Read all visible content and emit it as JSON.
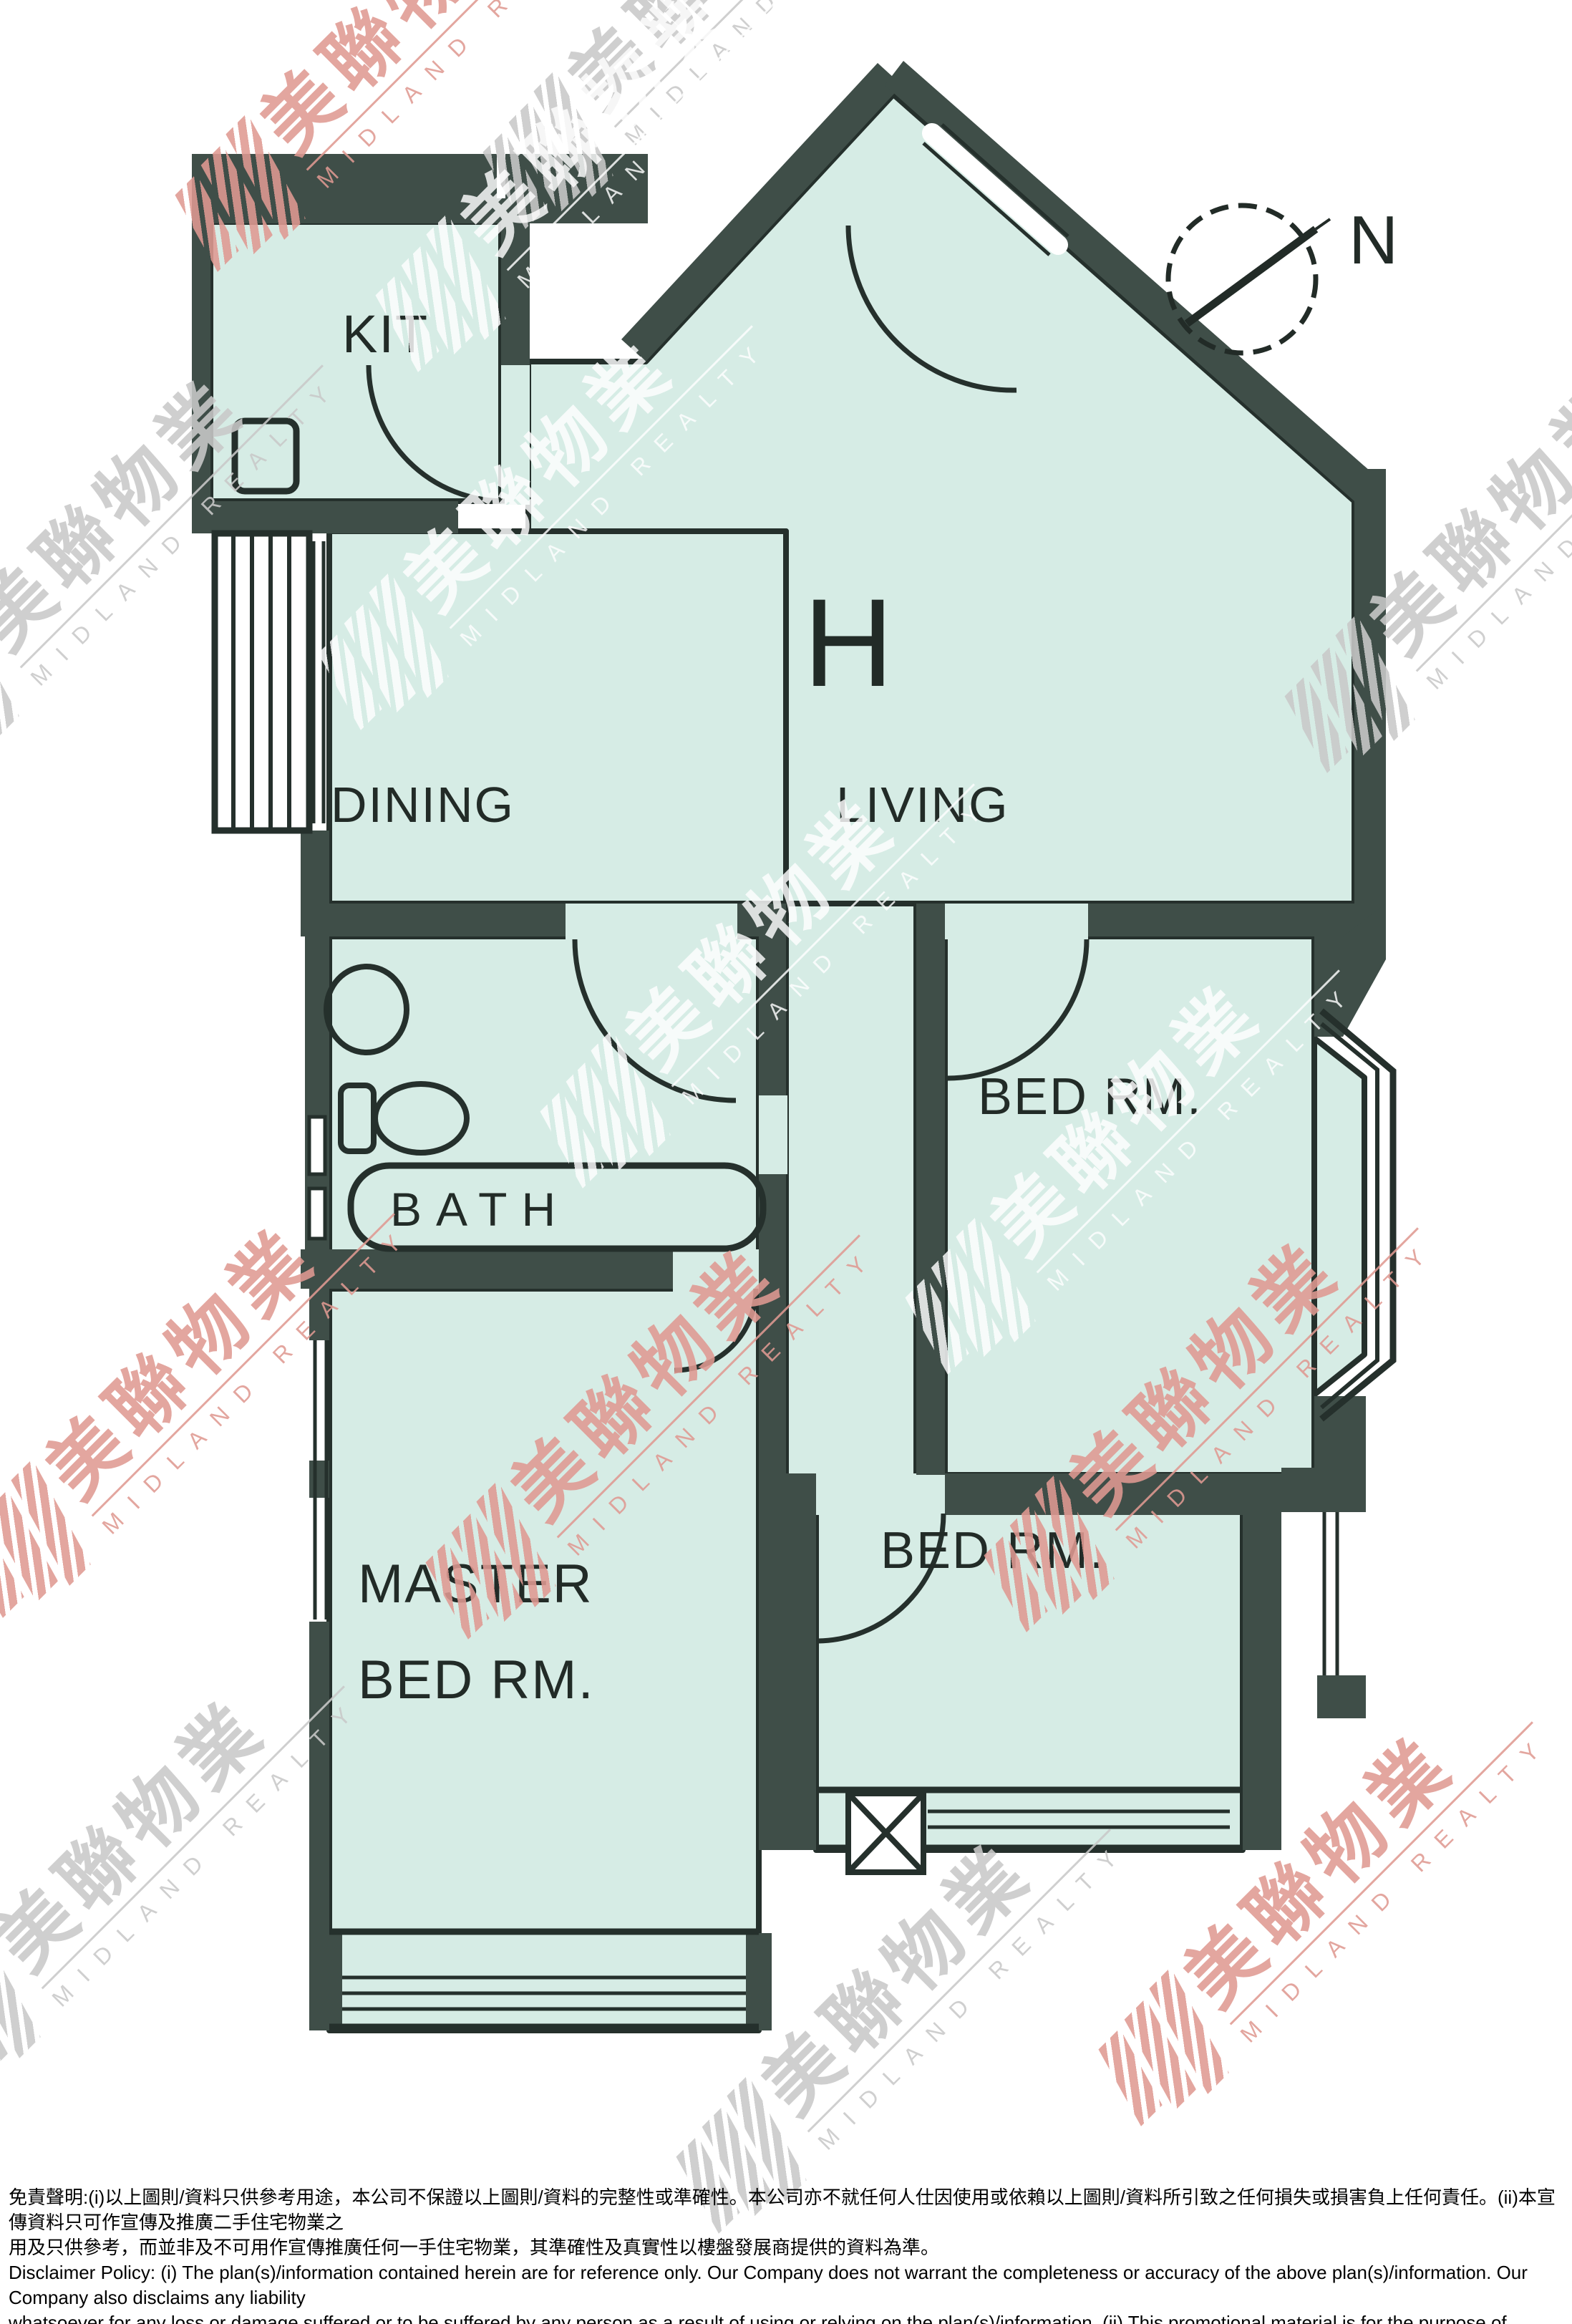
{
  "floorplan": {
    "unit_label": "H",
    "rooms": {
      "kitchen": "KIT",
      "dining": "DINING",
      "living": "LIVING",
      "bedroom1": "BED RM.",
      "bedroom2": "BED RM.",
      "master_line1": "MASTER",
      "master_line2": "BED RM.",
      "bath": "BATH"
    },
    "compass": {
      "north_label": "N"
    },
    "colors": {
      "wall": "#3f4e48",
      "floor": "#d6ece5",
      "line": "#25302c",
      "background": "#ffffff"
    }
  },
  "watermark": {
    "cjk": "美聯物業",
    "latin": "MIDLAND REALTY",
    "red": "#e09a92",
    "gray": "#c9c9c9"
  },
  "disclaimer": {
    "zh_line1": "免責聲明:(i)以上圖則/資料只供參考用途，本公司不保證以上圖則/資料的完整性或準確性。本公司亦不就任何人仕因使用或依賴以上圖則/資料所引致之任何損失或損害負上任何責任。(ii)本宣傳資料只可作宣傳及推廣二手住宅物業之",
    "zh_line2": "用及只供參考，而並非及不可用作宣傳推廣任何一手住宅物業，其準確性及真實性以樓盤發展商提供的資料為準。",
    "en_line1": "Disclaimer Policy: (i) The plan(s)/information contained herein are for reference only. Our Company does not warrant the completeness or accuracy of the above plan(s)/information. Our Company also disclaims any liability",
    "en_line2": "whatsoever for any loss or damage suffered or to be suffered by any person as a result of using or relying on the plan(s)/information. (ii) This promotional material is for the purpose of promoting second-hand residential",
    "en_line3": "properties and for reference only. This promotional material shall not be used for the purpose of promoting first-hand residential properties. The accuracy and truth of the information contained in this promotional",
    "en_line4": "material shall be subject to information provided by the developers."
  }
}
